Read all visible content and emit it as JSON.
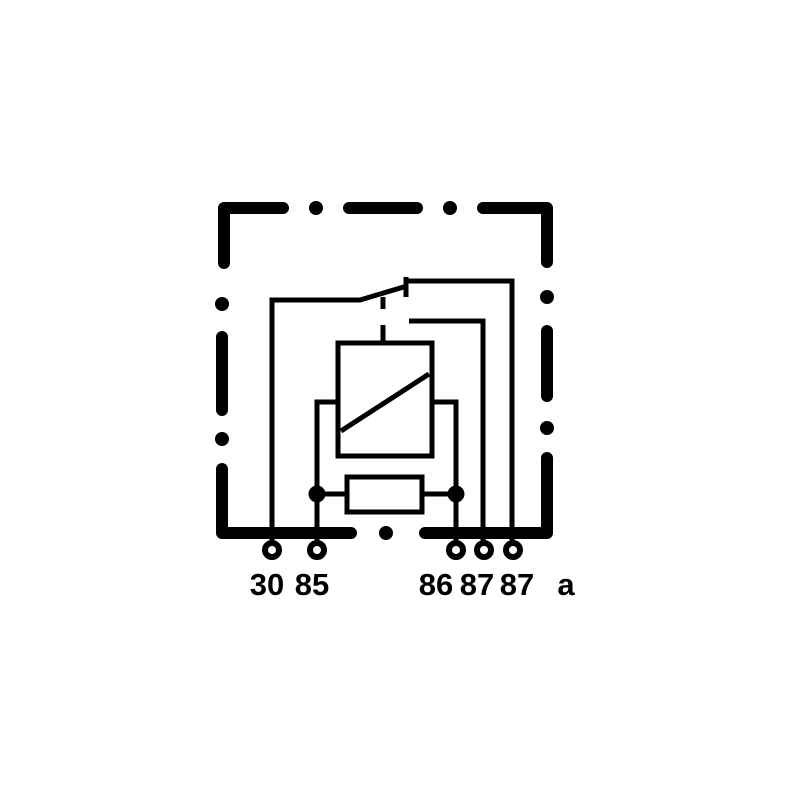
{
  "page": {
    "background_color": "#ffffff"
  },
  "diagram": {
    "kind": "relay-wiring-diagram",
    "line_color": "#000000",
    "fill_color": "#ffffff",
    "symbols": [
      "relay-housing-outline",
      "switch-arm",
      "contact-87a-tick",
      "armature-link-dashed",
      "coil-symbol",
      "resistor-symbol",
      "junction-dots",
      "terminal-pins"
    ],
    "terminal_labels": [
      "30",
      "85",
      "86",
      "87",
      "87",
      "a"
    ]
  }
}
